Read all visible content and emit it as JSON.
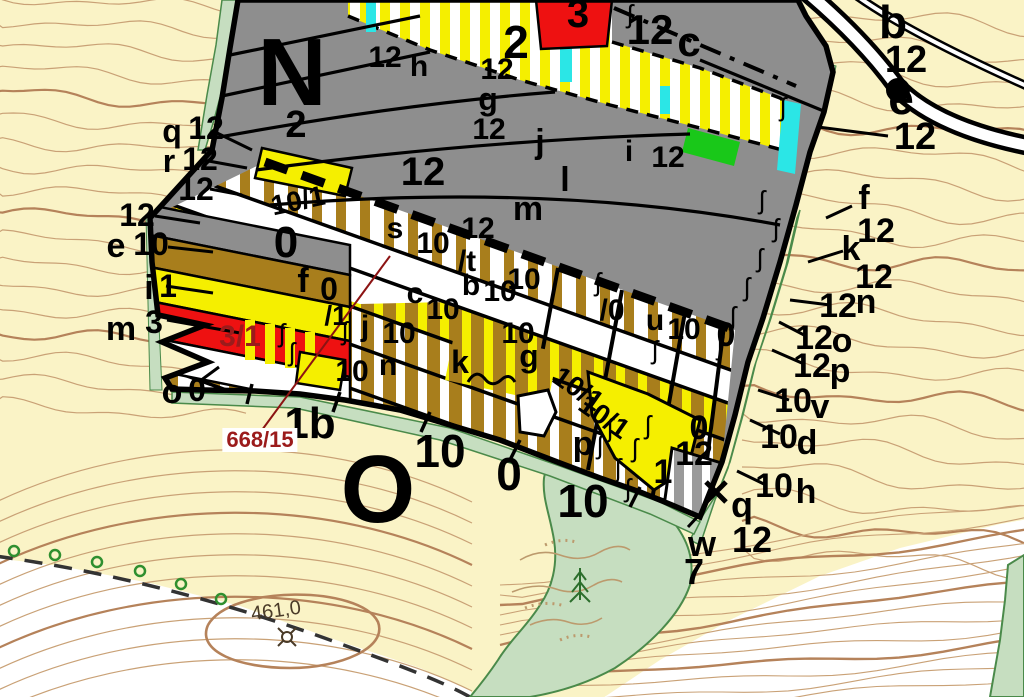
{
  "map": {
    "title": "forest-stand-cadastral-map",
    "colors": {
      "background_cream": "#FAF3C6",
      "contour_thin": "#C9A176",
      "contour_index": "#B5825A",
      "stand_gray": "#8E8E8E",
      "stand_brown": "#A87E1C",
      "stand_yellow": "#F5EF00",
      "stand_red": "#EE1111",
      "stand_cyan": "#2BE6E6",
      "stand_green": "#19C819",
      "vegetation_sage": "#C6DEC0",
      "vegetation_border": "#4A8A4A",
      "parcel_number_red": "#9B1B1B"
    },
    "parcel_number": {
      "text": "668/15"
    },
    "elevation_point": {
      "text": "461,0"
    },
    "compartment_letters": [
      "N",
      "O"
    ],
    "springs": {
      "glyph": "ʃ",
      "positions": [
        {
          "x": 630,
          "y": 14
        },
        {
          "x": 783,
          "y": 107
        },
        {
          "x": 762,
          "y": 200
        },
        {
          "x": 776,
          "y": 228
        },
        {
          "x": 760,
          "y": 258
        },
        {
          "x": 747,
          "y": 287
        },
        {
          "x": 733,
          "y": 316
        },
        {
          "x": 720,
          "y": 346
        },
        {
          "x": 598,
          "y": 282
        },
        {
          "x": 655,
          "y": 350
        },
        {
          "x": 610,
          "y": 428
        },
        {
          "x": 635,
          "y": 448
        },
        {
          "x": 618,
          "y": 468
        },
        {
          "x": 600,
          "y": 445
        },
        {
          "x": 648,
          "y": 425
        },
        {
          "x": 628,
          "y": 488
        },
        {
          "x": 282,
          "y": 333
        },
        {
          "x": 292,
          "y": 352
        },
        {
          "x": 345,
          "y": 331
        }
      ]
    },
    "labels": [
      {
        "t": "N",
        "x": 292,
        "y": 73,
        "s": 96,
        "n": "compartment-letter-N"
      },
      {
        "t": "O",
        "x": 378,
        "y": 490,
        "s": 96,
        "n": "compartment-letter-O"
      },
      {
        "t": "2",
        "x": 516,
        "y": 42,
        "s": 46
      },
      {
        "t": "3",
        "x": 578,
        "y": 14,
        "s": 40
      },
      {
        "t": "12",
        "x": 650,
        "y": 30,
        "s": 42
      },
      {
        "t": "c",
        "x": 689,
        "y": 42,
        "s": 42
      },
      {
        "t": "b",
        "x": 893,
        "y": 22,
        "s": 46
      },
      {
        "t": "12",
        "x": 906,
        "y": 60,
        "s": 38
      },
      {
        "t": "e",
        "x": 901,
        "y": 98,
        "s": 46
      },
      {
        "t": "12",
        "x": 915,
        "y": 137,
        "s": 38
      },
      {
        "t": "12",
        "x": 385,
        "y": 58,
        "s": 30
      },
      {
        "t": "h",
        "x": 419,
        "y": 67,
        "s": 30
      },
      {
        "t": "12",
        "x": 497,
        "y": 70,
        "s": 30
      },
      {
        "t": "g",
        "x": 488,
        "y": 99,
        "s": 32
      },
      {
        "t": "12",
        "x": 489,
        "y": 130,
        "s": 30
      },
      {
        "t": "j",
        "x": 540,
        "y": 142,
        "s": 34
      },
      {
        "t": "12",
        "x": 423,
        "y": 172,
        "s": 40
      },
      {
        "t": "i",
        "x": 629,
        "y": 152,
        "s": 30
      },
      {
        "t": "12",
        "x": 668,
        "y": 158,
        "s": 30
      },
      {
        "t": "l",
        "x": 565,
        "y": 180,
        "s": 34
      },
      {
        "t": "m",
        "x": 528,
        "y": 209,
        "s": 34
      },
      {
        "t": "2",
        "x": 296,
        "y": 125,
        "s": 38
      },
      {
        "t": "q",
        "x": 172,
        "y": 131,
        "s": 32
      },
      {
        "t": "12",
        "x": 206,
        "y": 128,
        "s": 32
      },
      {
        "t": "r",
        "x": 169,
        "y": 161,
        "s": 32
      },
      {
        "t": "12",
        "x": 200,
        "y": 159,
        "s": 32
      },
      {
        "t": "12",
        "x": 196,
        "y": 189,
        "s": 32
      },
      {
        "t": "12",
        "x": 137,
        "y": 215,
        "s": 32
      },
      {
        "t": "e",
        "x": 116,
        "y": 246,
        "s": 34
      },
      {
        "t": "10",
        "x": 151,
        "y": 244,
        "s": 32
      },
      {
        "t": "i",
        "x": 149,
        "y": 288,
        "s": 34
      },
      {
        "t": "1",
        "x": 168,
        "y": 286,
        "s": 32
      },
      {
        "t": "m",
        "x": 121,
        "y": 329,
        "s": 34
      },
      {
        "t": "3",
        "x": 154,
        "y": 322,
        "s": 32
      },
      {
        "t": "o",
        "x": 172,
        "y": 392,
        "s": 34
      },
      {
        "t": "0",
        "x": 197,
        "y": 390,
        "s": 32
      },
      {
        "t": "3/1",
        "x": 240,
        "y": 337,
        "s": 30,
        "c": "#9B1B1B",
        "n": "parcel-label-3-1"
      },
      {
        "t": "10/1",
        "x": 298,
        "y": 201,
        "s": 28,
        "r": -12
      },
      {
        "t": "s",
        "x": 395,
        "y": 229,
        "s": 30
      },
      {
        "t": "10",
        "x": 433,
        "y": 244,
        "s": 30
      },
      {
        "t": "12",
        "x": 478,
        "y": 229,
        "s": 30
      },
      {
        "t": "0",
        "x": 286,
        "y": 243,
        "s": 44
      },
      {
        "t": "f",
        "x": 303,
        "y": 281,
        "s": 34
      },
      {
        "t": "0",
        "x": 329,
        "y": 289,
        "s": 32
      },
      {
        "t": "c",
        "x": 415,
        "y": 294,
        "s": 30
      },
      {
        "t": "10",
        "x": 443,
        "y": 310,
        "s": 30
      },
      {
        "t": "/t",
        "x": 467,
        "y": 262,
        "s": 30
      },
      {
        "t": "10",
        "x": 524,
        "y": 280,
        "s": 30
      },
      {
        "t": "b",
        "x": 471,
        "y": 286,
        "s": 30
      },
      {
        "t": "10",
        "x": 500,
        "y": 292,
        "s": 30
      },
      {
        "t": "/0",
        "x": 612,
        "y": 311,
        "s": 30
      },
      {
        "t": "u",
        "x": 655,
        "y": 321,
        "s": 30
      },
      {
        "t": "10",
        "x": 684,
        "y": 330,
        "s": 30
      },
      {
        "t": "0",
        "x": 726,
        "y": 335,
        "s": 34
      },
      {
        "t": "/1",
        "x": 336,
        "y": 316,
        "s": 28
      },
      {
        "t": "j",
        "x": 365,
        "y": 327,
        "s": 30
      },
      {
        "t": "10",
        "x": 399,
        "y": 334,
        "s": 30
      },
      {
        "t": "10",
        "x": 352,
        "y": 372,
        "s": 30
      },
      {
        "t": "n",
        "x": 388,
        "y": 366,
        "s": 30
      },
      {
        "t": "k",
        "x": 460,
        "y": 362,
        "s": 32
      },
      {
        "t": "g",
        "x": 529,
        "y": 356,
        "s": 32
      },
      {
        "t": "10",
        "x": 518,
        "y": 334,
        "s": 30
      },
      {
        "t": "10/1",
        "x": 578,
        "y": 389,
        "s": 28,
        "r": 35
      },
      {
        "t": "10/1",
        "x": 604,
        "y": 417,
        "s": 28,
        "r": 35
      },
      {
        "t": "p",
        "x": 583,
        "y": 444,
        "s": 34
      },
      {
        "t": "0",
        "x": 699,
        "y": 428,
        "s": 34
      },
      {
        "t": "12",
        "x": 694,
        "y": 454,
        "s": 34
      },
      {
        "t": "1",
        "x": 663,
        "y": 472,
        "s": 34
      },
      {
        "t": "q",
        "x": 742,
        "y": 505,
        "s": 36
      },
      {
        "t": "w",
        "x": 702,
        "y": 544,
        "s": 36
      },
      {
        "t": "12",
        "x": 752,
        "y": 540,
        "s": 36
      },
      {
        "t": "7",
        "x": 694,
        "y": 572,
        "s": 36
      },
      {
        "t": "10",
        "x": 774,
        "y": 486,
        "s": 34
      },
      {
        "t": "h",
        "x": 806,
        "y": 492,
        "s": 34
      },
      {
        "t": "10",
        "x": 779,
        "y": 437,
        "s": 34
      },
      {
        "t": "d",
        "x": 807,
        "y": 443,
        "s": 34
      },
      {
        "t": "10",
        "x": 793,
        "y": 401,
        "s": 34
      },
      {
        "t": "v",
        "x": 820,
        "y": 407,
        "s": 34
      },
      {
        "t": "12",
        "x": 812,
        "y": 366,
        "s": 34
      },
      {
        "t": "p",
        "x": 840,
        "y": 371,
        "s": 34
      },
      {
        "t": "12",
        "x": 814,
        "y": 338,
        "s": 34
      },
      {
        "t": "o",
        "x": 842,
        "y": 341,
        "s": 34
      },
      {
        "t": "12",
        "x": 838,
        "y": 306,
        "s": 34
      },
      {
        "t": "n",
        "x": 866,
        "y": 302,
        "s": 34
      },
      {
        "t": "12",
        "x": 874,
        "y": 277,
        "s": 34
      },
      {
        "t": "k",
        "x": 851,
        "y": 249,
        "s": 34
      },
      {
        "t": "12",
        "x": 876,
        "y": 231,
        "s": 34
      },
      {
        "t": "f",
        "x": 864,
        "y": 198,
        "s": 34
      },
      {
        "t": "1b",
        "x": 310,
        "y": 424,
        "s": 44
      },
      {
        "t": "668/15",
        "x": 260,
        "y": 440,
        "s": 22,
        "c": "#9B1B1B",
        "bg": "#FFFFFF",
        "n": "parcel-number-668-15"
      },
      {
        "t": "10",
        "x": 440,
        "y": 451,
        "s": 46
      },
      {
        "t": "0",
        "x": 509,
        "y": 474,
        "s": 46
      },
      {
        "t": "10",
        "x": 583,
        "y": 501,
        "s": 46
      },
      {
        "t": "461,0",
        "x": 276,
        "y": 611,
        "s": 20,
        "r": -8,
        "c": "#4a3b28",
        "b": 0,
        "n": "elevation-label"
      }
    ]
  }
}
